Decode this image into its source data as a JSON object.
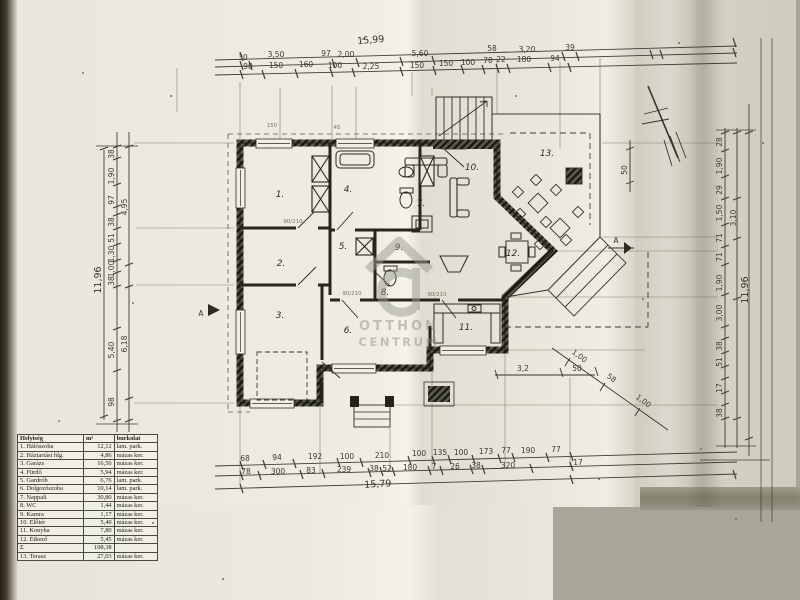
{
  "colors": {
    "paper": "#edebe2",
    "ink": "#2e2d27",
    "background": "#a7a699",
    "watermark": "#92938a"
  },
  "table": {
    "headers": [
      "Helyiség",
      "m²",
      "burkolat"
    ],
    "rows": [
      [
        "1. Hálószoba",
        "12,12",
        "lam. park."
      ],
      [
        "2. Háztartási hlg.",
        "4,86",
        "mázas ker."
      ],
      [
        "3. Garázs",
        "16,50",
        "mázas ker."
      ],
      [
        "4. Fürdő",
        "5,94",
        "mázas ker."
      ],
      [
        "5. Gardrób",
        "6,76",
        "lam. park."
      ],
      [
        "6. Dolgozószoba",
        "10,14",
        "lam. park."
      ],
      [
        "7. Nappali",
        "30,80",
        "mázas ker."
      ],
      [
        "8. WC",
        "1,44",
        "mázas ker."
      ],
      [
        "9. Kamra",
        "1,17",
        "mázas ker."
      ],
      [
        "10. Előtér",
        "5,40",
        "mázas ker."
      ],
      [
        "11. Konyha",
        "7,80",
        "mázas ker."
      ],
      [
        "12. Étkező",
        "5,45",
        "mázas ker."
      ],
      [
        "Σ",
        "108,38",
        ""
      ],
      [
        "13. Terasz",
        "27,03",
        "mázas ker."
      ]
    ]
  },
  "dims": {
    "top_total": "15,99",
    "bottom_total": "15,79",
    "top_row1": [
      "30",
      "3,50",
      "97",
      "2,00",
      "5,60",
      "58",
      "3,20",
      "39"
    ],
    "top_row2": [
      "98",
      "150",
      "160",
      "100",
      "2,25",
      "150",
      "150",
      "100",
      "78",
      "22",
      "180",
      "94"
    ],
    "bottom_row1": [
      "68",
      "94",
      "192",
      "100",
      "210",
      "100",
      "135",
      "100",
      "173",
      "77",
      "190",
      "77"
    ],
    "bottom_row2": [
      "78",
      "300",
      "83",
      "239",
      "38",
      "52",
      "180",
      "7",
      "26",
      "38",
      "320",
      "17"
    ],
    "left_inner": [
      "38",
      "1,90",
      "97",
      "38",
      "51",
      "1,30",
      "1,00",
      "38",
      "5,40",
      "98"
    ],
    "left_mid": [
      "4,95",
      "6,18"
    ],
    "left_total": "11,96",
    "right_inner": [
      "28",
      "1,90",
      "29",
      "1,50",
      "71",
      "71",
      "1,90",
      "3,00",
      "38",
      "51",
      "17",
      "38"
    ],
    "right_mid": "3,10",
    "right_total": "11,96",
    "terrace_width": "3,2",
    "terrace_w2": "50",
    "terrace_side": "50",
    "diag": [
      "1,00",
      "58",
      "1,00"
    ]
  },
  "rooms": {
    "r1": "1.",
    "r2": "2.",
    "r3": "3.",
    "r4": "4.",
    "r5": "5.",
    "r6": "6.",
    "r7": "7.",
    "r8": "8.",
    "r9": "9.",
    "r10": "10.",
    "r11": "11.",
    "r12": "12.",
    "r13": "13."
  },
  "annotations": {
    "door1": "90/210",
    "door2": "90/210",
    "door3": "90/210",
    "above1": "150",
    "above2": "45"
  },
  "markers": {
    "section_left": "A",
    "section_right": "A"
  },
  "watermark": {
    "line1": "OTTHON",
    "line2": "CENTRUM"
  }
}
